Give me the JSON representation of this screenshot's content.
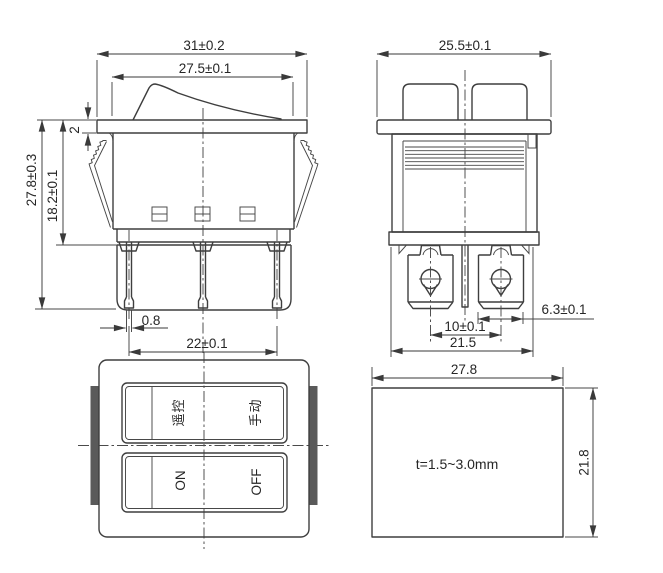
{
  "drawing": {
    "type": "rocker-switch-technical-drawing",
    "colors": {
      "line": "#3e3e3e",
      "clip_fill": "#5a5a5a",
      "background": "#ffffff"
    },
    "views": {
      "front": {
        "dim_width_outer": "31±0.2",
        "dim_width_rocker": "27.5±0.1",
        "dim_flange_thickness": "2",
        "dim_body_height": "18.2±0.1",
        "dim_total_height": "27.8±0.3",
        "dim_pin_thickness": "0.8",
        "dim_pin_span": "22±0.1"
      },
      "side": {
        "dim_width": "25.5±0.1",
        "dim_terminal_width": "6.3±0.1",
        "dim_screw_span": "10±0.1",
        "dim_base_width": "21.5"
      },
      "top": {
        "label_rocker1_left": "遥控",
        "label_rocker1_right": "手动",
        "label_rocker2_left": "ON",
        "label_rocker2_right": "OFF"
      },
      "cutout": {
        "dim_width": "27.8",
        "dim_height": "21.8",
        "note": "t=1.5~3.0mm"
      }
    }
  }
}
